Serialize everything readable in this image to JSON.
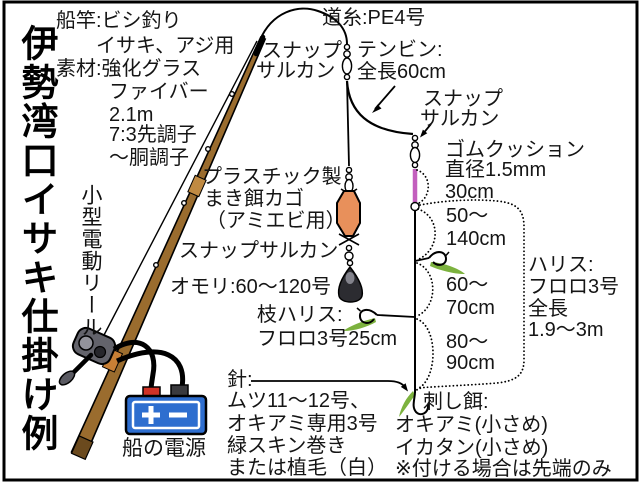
{
  "title": "伊勢湾口イサキ仕掛け例",
  "colors": {
    "rod_brown": "#9A6C2E",
    "rod_joint": "#C08A42",
    "reel_seat_orange": "#C87F35",
    "cage_orange": "#E8905B",
    "cushion_pink": "#C35FBE",
    "feather_green": "#7CB23E",
    "battery_blue": "#2E6ECF",
    "terminal_red": "#D03226",
    "terminal_dark": "#3A3A3E",
    "sinker_dark": "#2C2C31",
    "line_black": "#000000"
  },
  "icons": {
    "battery_plus_icon": "＋",
    "battery_minus_icon": "−"
  },
  "labels": {
    "rod_use_1": "船竿:ビシ釣り",
    "rod_use_2": "イサキ、アジ用",
    "material_1": "素材:強化グラス",
    "material_2": "ファイバー",
    "material_3": "2.1m",
    "material_4": "7:3先調子",
    "material_5": "〜胴調子",
    "reel": "小型電動リール",
    "cage_1": "プラスチック製",
    "cage_2": "まき餌カゴ",
    "cage_3": "（アミエビ用）",
    "snap_swivel_cage": "スナップサルカン",
    "sinker": "オモリ:60〜120号",
    "branch_leader_1": "枝ハリス:",
    "branch_leader_2": "フロロ3号25cm",
    "hook_1": "針:",
    "hook_2": "ムツ11〜12号、",
    "hook_3": "オキアミ専用3号",
    "hook_4": "緑スキン巻き",
    "hook_5": "または植毛（白）",
    "power": "船の電源",
    "main_line": "道糸:PE4号",
    "snap_top_1": "スナップ",
    "snap_top_2": "サルカン",
    "tenbin_1": "テンビン:",
    "tenbin_2": "全長60cm",
    "snap_right_1": "スナップ",
    "snap_right_2": "サルカン",
    "cushion_1": "ゴムクッション",
    "cushion_2": "直径1.5mm",
    "cushion_3": "30cm",
    "seg1_1": "50〜",
    "seg1_2": "140cm",
    "seg2_1": "60〜",
    "seg2_2": "70cm",
    "seg3_1": "80〜",
    "seg3_2": "90cm",
    "harisu_1": "ハリス:",
    "harisu_2": "フロロ3号",
    "harisu_3": "全長",
    "harisu_4": "1.9〜3m",
    "bait_1": "刺し餌:",
    "bait_2": "オキアミ(小さめ)",
    "bait_3": "イカタン(小さめ)",
    "bait_4": "※付ける場合は先端のみ"
  }
}
